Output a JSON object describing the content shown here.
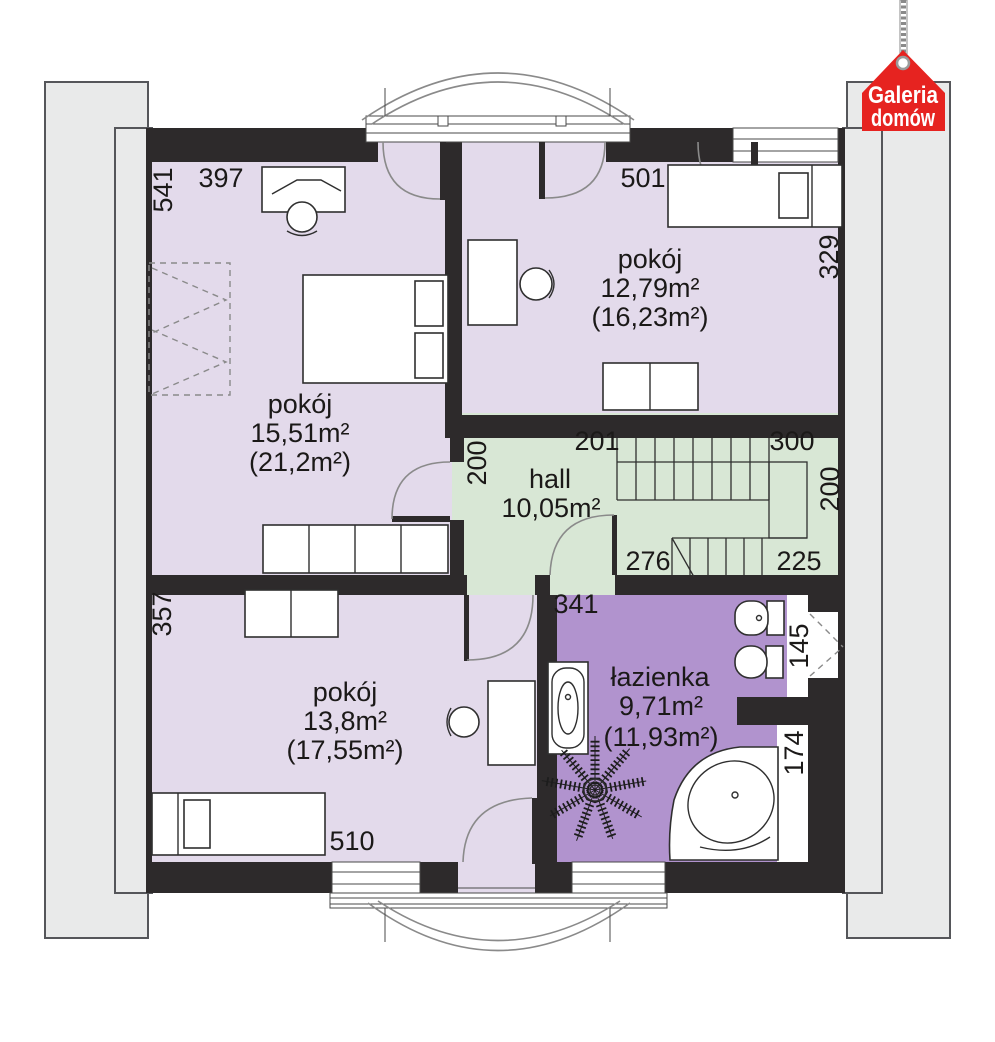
{
  "logo": {
    "line1": "Galeria",
    "line2": "domów"
  },
  "rooms": {
    "bedroom_top_left": {
      "name": "pokój",
      "area": "15,51m²",
      "area_gross": "(21,2m²)"
    },
    "bedroom_top_right": {
      "name": "pokój",
      "area": "12,79m²",
      "area_gross": "(16,23m²)"
    },
    "hall": {
      "name": "hall",
      "area": "10,05m²"
    },
    "bedroom_bottom_left": {
      "name": "pokój",
      "area": "13,8m²",
      "area_gross": "(17,55m²)"
    },
    "bathroom": {
      "name": "łazienka",
      "area": "9,71m²",
      "area_gross": "(11,93m²)"
    }
  },
  "dimensions_cm": {
    "d541": "541",
    "d397": "397",
    "d501": "501",
    "d329": "329",
    "d200_left": "200",
    "d201": "201",
    "d300": "300",
    "d200_right": "200",
    "d276": "276",
    "d225": "225",
    "d357": "357",
    "d341": "341",
    "d145": "145",
    "d174": "174",
    "d510": "510"
  },
  "colors": {
    "room_fill": "#e3daeb",
    "hall_fill": "#d8e7d5",
    "bathroom_fill": "#b193ce",
    "wall": "#2d2a2b",
    "roof_area": "#e9eaea",
    "logo_red": "#e62320",
    "text": "#1b1918"
  }
}
